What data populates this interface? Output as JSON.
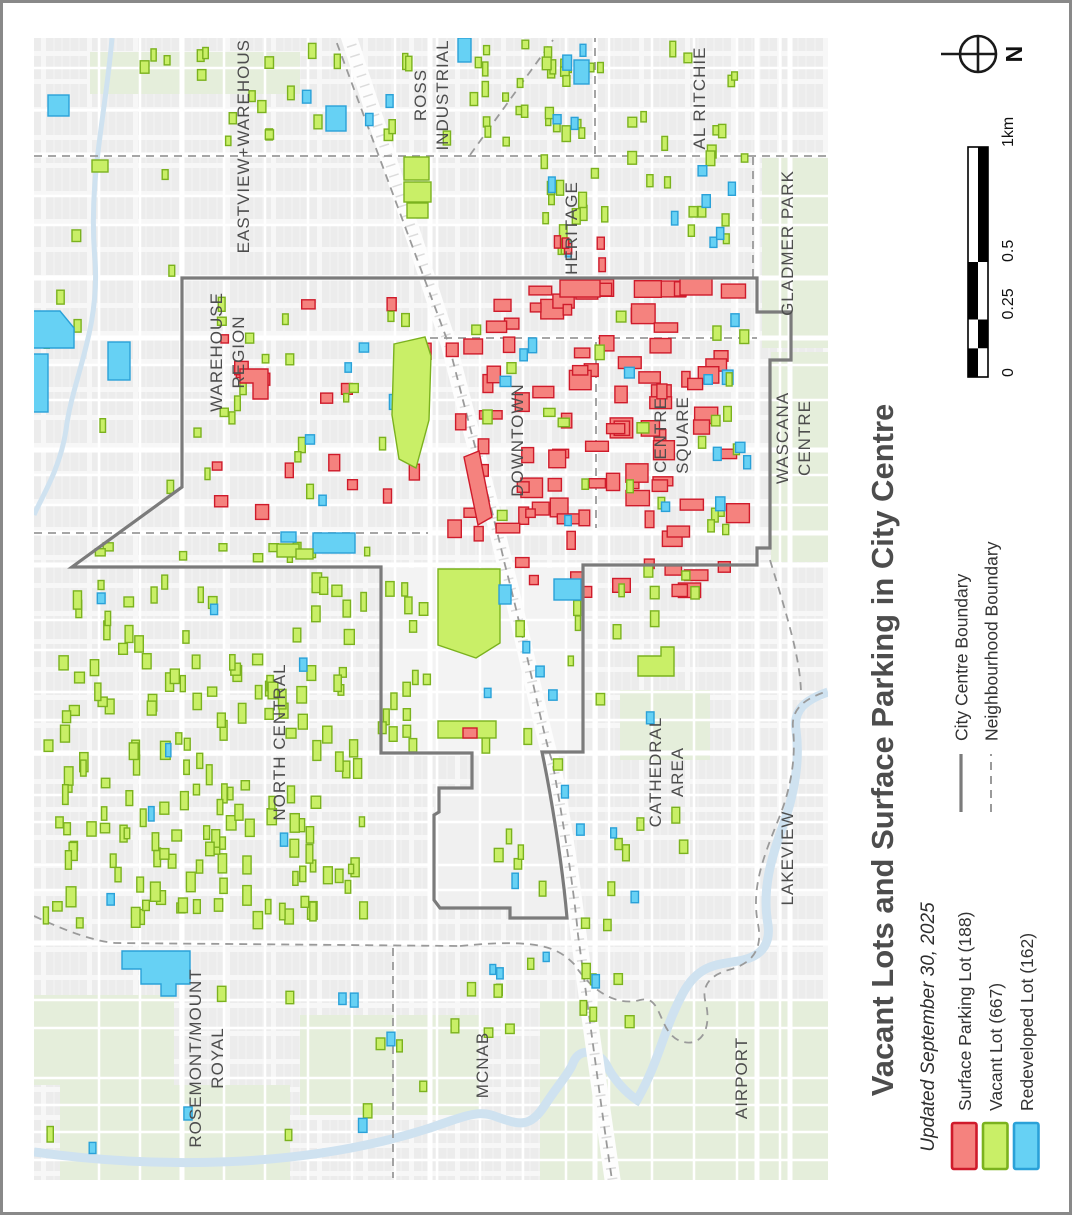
{
  "page": {
    "title": "Vacant Lots and Surface Parking in City Centre",
    "subtitle": "Updated September 30, 2025"
  },
  "north": {
    "label": "N"
  },
  "scalebar": {
    "ticks": [
      "0",
      "0.25",
      "0.5",
      "1km"
    ]
  },
  "legend": {
    "lots": [
      {
        "id": "surface-parking-lot",
        "label": "Surface Parking Lot (188)",
        "fill": "#F5827E",
        "stroke": "#CF1B2B"
      },
      {
        "id": "vacant-lot",
        "label": "Vacant Lot (667)",
        "fill": "#C9EF67",
        "stroke": "#7BB21E"
      },
      {
        "id": "redeveloped-lot",
        "label": "Redeveloped Lot (162)",
        "fill": "#66D1F4",
        "stroke": "#2AA1D8"
      }
    ],
    "boundaries": [
      {
        "id": "city-centre-boundary",
        "label": "City Centre Boundary",
        "style": "solid"
      },
      {
        "id": "neighbourhood-boundary",
        "label": "Neighbourhood Boundary",
        "style": "dashed"
      }
    ]
  },
  "map": {
    "labels": [
      {
        "x": 249,
        "y": 140,
        "lines": [
          "EASTVIEW+WAREHOUSE"
        ]
      },
      {
        "x": 437,
        "y": 95,
        "lines": [
          "ROSS",
          "INDUSTRIAL"
        ]
      },
      {
        "x": 577,
        "y": 228,
        "lines": [
          "HERITAGE"
        ]
      },
      {
        "x": 705,
        "y": 98,
        "lines": [
          "AL RITCHIE"
        ]
      },
      {
        "x": 793,
        "y": 243,
        "lines": [
          "GLADMER PARK"
        ]
      },
      {
        "x": 233,
        "y": 352,
        "lines": [
          "WAREHOUSE",
          "REGION"
        ]
      },
      {
        "x": 523,
        "y": 440,
        "lines": [
          "DOWNTOWN"
        ]
      },
      {
        "x": 677,
        "y": 435,
        "lines": [
          "CENTRE",
          "SQUARE"
        ]
      },
      {
        "x": 799,
        "y": 438,
        "lines": [
          "WASCANA",
          "CENTRE"
        ]
      },
      {
        "x": 285,
        "y": 742,
        "lines": [
          "NORTH CENTRAL"
        ]
      },
      {
        "x": 672,
        "y": 772,
        "lines": [
          "CATHEDRAL",
          "AREA"
        ]
      },
      {
        "x": 793,
        "y": 858,
        "lines": [
          "LAKEVIEW"
        ]
      },
      {
        "x": 212,
        "y": 1058,
        "lines": [
          "ROSEMONT/MOUNT",
          "ROYAL"
        ]
      },
      {
        "x": 488,
        "y": 1065,
        "lines": [
          "MCNAB"
        ]
      },
      {
        "x": 747,
        "y": 1078,
        "lines": [
          "AIRPORT"
        ]
      }
    ],
    "city_centre_boundary": "M182,278 L757,278 L757,312 L791,312 L791,360 L770,360 L770,548 L757,548 L757,565 L583,565 L583,752 L542,752 C550,790 562,860 567,918 L510,918 L510,908 L440,908 L434,900 L434,815 L439,812 L439,788 L472,788 L472,753 L381,753 L381,567 L72,567 L182,487 Z",
    "neighbourhood_boundaries": [
      "M34,156 L828,156",
      "M470,155 L553,40",
      "M332,30 L449,345 C470,430 490,500 505,565 C525,640 545,745 552,760 C565,830 575,900 578,935 C590,1020 600,1100 612,1180",
      "M430,338 L757,338",
      "M596,342 L596,528",
      "M595,34 L595,155",
      "M753,157 L753,277",
      "M34,533 L428,533",
      "M34,916 C70,933 95,941 115,943 L460,946",
      "M393,948 L393,1178",
      "M460,946 C540,938 558,948 574,964 C594,994 618,1006 640,1000 C662,994 658,1030 678,1040 C700,1050 712,1030 706,1004 C700,984 712,974 732,969 C757,961 762,944 758,924 C751,888 763,858 779,818 C791,788 796,758 793,728 C791,708 806,698 828,691",
      "M770,560 C790,625 800,660 801,692"
    ],
    "featured_lots": [
      {
        "t": "g",
        "d": "M394,344 L425,337 L431,356 L429,420 L416,468 L399,459 L392,415 Z"
      },
      {
        "t": "g",
        "d": "M438,569 L500,569 L500,643 L476,658 L438,645 Z"
      },
      {
        "t": "g",
        "r": [
          438,
          721,
          58,
          17
        ]
      },
      {
        "t": "r",
        "r": [
          463,
          728,
          14,
          10
        ]
      },
      {
        "t": "g",
        "d": "M638,656 L661,656 L661,647 L674,647 L674,676 L638,676 Z"
      },
      {
        "t": "g",
        "r": [
          404,
          157,
          25,
          23
        ]
      },
      {
        "t": "g",
        "r": [
          404,
          182,
          27,
          20
        ]
      },
      {
        "t": "g",
        "r": [
          407,
          203,
          21,
          15
        ]
      },
      {
        "t": "b",
        "r": [
          458,
          38,
          13,
          24
        ]
      },
      {
        "t": "b",
        "r": [
          48,
          95,
          21,
          21
        ]
      },
      {
        "t": "b",
        "d": "M33,311 L60,311 L74,328 L74,348 L33,348 Z"
      },
      {
        "t": "b",
        "r": [
          33,
          354,
          15,
          58
        ]
      },
      {
        "t": "b",
        "r": [
          108,
          342,
          22,
          38
        ]
      },
      {
        "t": "b",
        "r": [
          326,
          106,
          20,
          25
        ]
      },
      {
        "t": "b",
        "r": [
          313,
          533,
          42,
          20
        ]
      },
      {
        "t": "g",
        "r": [
          277,
          544,
          22,
          13
        ]
      },
      {
        "t": "g",
        "r": [
          296,
          549,
          17,
          10
        ]
      },
      {
        "t": "b",
        "r": [
          281,
          532,
          15,
          10
        ]
      },
      {
        "t": "b",
        "d": "M122,951 L190,951 L190,984 L176,984 L176,996 L161,996 L161,984 L141,984 L141,969 L122,969 Z"
      },
      {
        "t": "b",
        "r": [
          554,
          579,
          27,
          21
        ]
      },
      {
        "t": "b",
        "r": [
          499,
          585,
          12,
          19
        ]
      },
      {
        "t": "r",
        "d": "M464,457 L479,451 L492,517 L478,525 Z"
      },
      {
        "t": "r",
        "d": "M240,369 L268,369 L268,399 L253,399 L253,383 L240,383 Z"
      },
      {
        "t": "b",
        "r": [
          574,
          60,
          15,
          24
        ]
      },
      {
        "t": "r",
        "r": [
          560,
          280,
          40,
          17
        ]
      },
      {
        "t": "r",
        "r": [
          680,
          278,
          32,
          17
        ]
      },
      {
        "t": "g",
        "r": [
          92,
          160,
          16,
          12
        ]
      }
    ],
    "lot_clusters": [
      {
        "t": "g",
        "x": 42,
        "y": 572,
        "w": 330,
        "h": 360,
        "n": 165,
        "s": [
          5,
          10,
          9,
          20
        ]
      },
      {
        "t": "b",
        "x": 60,
        "y": 580,
        "w": 300,
        "h": 340,
        "n": 7,
        "s": [
          5,
          9,
          10,
          17
        ]
      },
      {
        "t": "g",
        "x": 376,
        "y": 570,
        "w": 58,
        "h": 185,
        "n": 15,
        "s": [
          5,
          9,
          9,
          17
        ]
      },
      {
        "t": "g",
        "x": 140,
        "y": 42,
        "w": 290,
        "h": 105,
        "n": 22,
        "s": [
          5,
          9,
          8,
          16
        ]
      },
      {
        "t": "b",
        "x": 290,
        "y": 52,
        "w": 165,
        "h": 85,
        "n": 3,
        "s": [
          5,
          9,
          9,
          16
        ]
      },
      {
        "t": "g",
        "x": 440,
        "y": 40,
        "w": 115,
        "h": 112,
        "n": 15,
        "s": [
          5,
          9,
          8,
          16
        ]
      },
      {
        "t": "g",
        "x": 540,
        "y": 36,
        "w": 68,
        "h": 238,
        "n": 28,
        "s": [
          5,
          9,
          8,
          16
        ]
      },
      {
        "t": "b",
        "x": 545,
        "y": 42,
        "w": 58,
        "h": 225,
        "n": 6,
        "s": [
          5,
          9,
          9,
          16
        ]
      },
      {
        "t": "r",
        "x": 540,
        "y": 225,
        "w": 68,
        "h": 52,
        "n": 5,
        "s": [
          6,
          11,
          8,
          14
        ]
      },
      {
        "t": "g",
        "x": 602,
        "y": 40,
        "w": 155,
        "h": 230,
        "n": 20,
        "s": [
          5,
          9,
          8,
          16
        ]
      },
      {
        "t": "b",
        "x": 640,
        "y": 145,
        "w": 118,
        "h": 135,
        "n": 6,
        "s": [
          6,
          10,
          9,
          15
        ]
      },
      {
        "t": "r",
        "x": 445,
        "y": 286,
        "w": 308,
        "h": 265,
        "n": 80,
        "s": [
          8,
          24,
          8,
          20
        ]
      },
      {
        "t": "g",
        "x": 450,
        "y": 290,
        "w": 298,
        "h": 260,
        "n": 15,
        "s": [
          6,
          12,
          8,
          15
        ]
      },
      {
        "t": "b",
        "x": 460,
        "y": 300,
        "w": 285,
        "h": 245,
        "n": 7,
        "s": [
          6,
          11,
          8,
          15
        ]
      },
      {
        "t": "r",
        "x": 192,
        "y": 286,
        "w": 246,
        "h": 240,
        "n": 18,
        "s": [
          7,
          17,
          8,
          17
        ]
      },
      {
        "t": "g",
        "x": 192,
        "y": 286,
        "w": 246,
        "h": 240,
        "n": 21,
        "s": [
          5,
          10,
          8,
          16
        ]
      },
      {
        "t": "b",
        "x": 210,
        "y": 300,
        "w": 220,
        "h": 215,
        "n": 5,
        "s": [
          6,
          10,
          9,
          15
        ]
      },
      {
        "t": "r",
        "x": 540,
        "y": 279,
        "w": 212,
        "h": 22,
        "n": 7,
        "s": [
          10,
          28,
          12,
          17
        ]
      },
      {
        "t": "r",
        "x": 440,
        "y": 556,
        "w": 318,
        "h": 44,
        "n": 11,
        "s": [
          8,
          24,
          8,
          15
        ]
      },
      {
        "t": "g",
        "x": 460,
        "y": 600,
        "w": 230,
        "h": 335,
        "n": 24,
        "s": [
          5,
          9,
          9,
          17
        ]
      },
      {
        "t": "b",
        "x": 480,
        "y": 640,
        "w": 215,
        "h": 295,
        "n": 10,
        "s": [
          5,
          9,
          9,
          16
        ]
      },
      {
        "t": "g",
        "x": 440,
        "y": 952,
        "w": 210,
        "h": 88,
        "n": 13,
        "s": [
          5,
          9,
          9,
          16
        ]
      },
      {
        "t": "b",
        "x": 440,
        "y": 952,
        "w": 165,
        "h": 60,
        "n": 4,
        "s": [
          5,
          9,
          9,
          15
        ]
      },
      {
        "t": "g",
        "x": 45,
        "y": 950,
        "w": 410,
        "h": 215,
        "n": 8,
        "s": [
          5,
          9,
          9,
          16
        ]
      },
      {
        "t": "b",
        "x": 60,
        "y": 985,
        "w": 395,
        "h": 180,
        "n": 6,
        "s": [
          5,
          9,
          9,
          15
        ]
      },
      {
        "t": "g",
        "x": 698,
        "y": 300,
        "w": 60,
        "h": 255,
        "n": 8,
        "s": [
          5,
          9,
          9,
          15
        ]
      },
      {
        "t": "b",
        "x": 700,
        "y": 310,
        "w": 58,
        "h": 245,
        "n": 6,
        "s": [
          6,
          10,
          9,
          14
        ]
      },
      {
        "t": "g",
        "x": 42,
        "y": 165,
        "w": 135,
        "h": 350,
        "n": 8,
        "s": [
          5,
          9,
          9,
          15
        ]
      },
      {
        "t": "g",
        "x": 60,
        "y": 540,
        "w": 320,
        "h": 24,
        "n": 10,
        "s": [
          5,
          10,
          7,
          12
        ]
      },
      {
        "t": "g",
        "x": 608,
        "y": 560,
        "w": 150,
        "h": 40,
        "n": 5,
        "s": [
          5,
          9,
          8,
          13
        ]
      }
    ]
  }
}
